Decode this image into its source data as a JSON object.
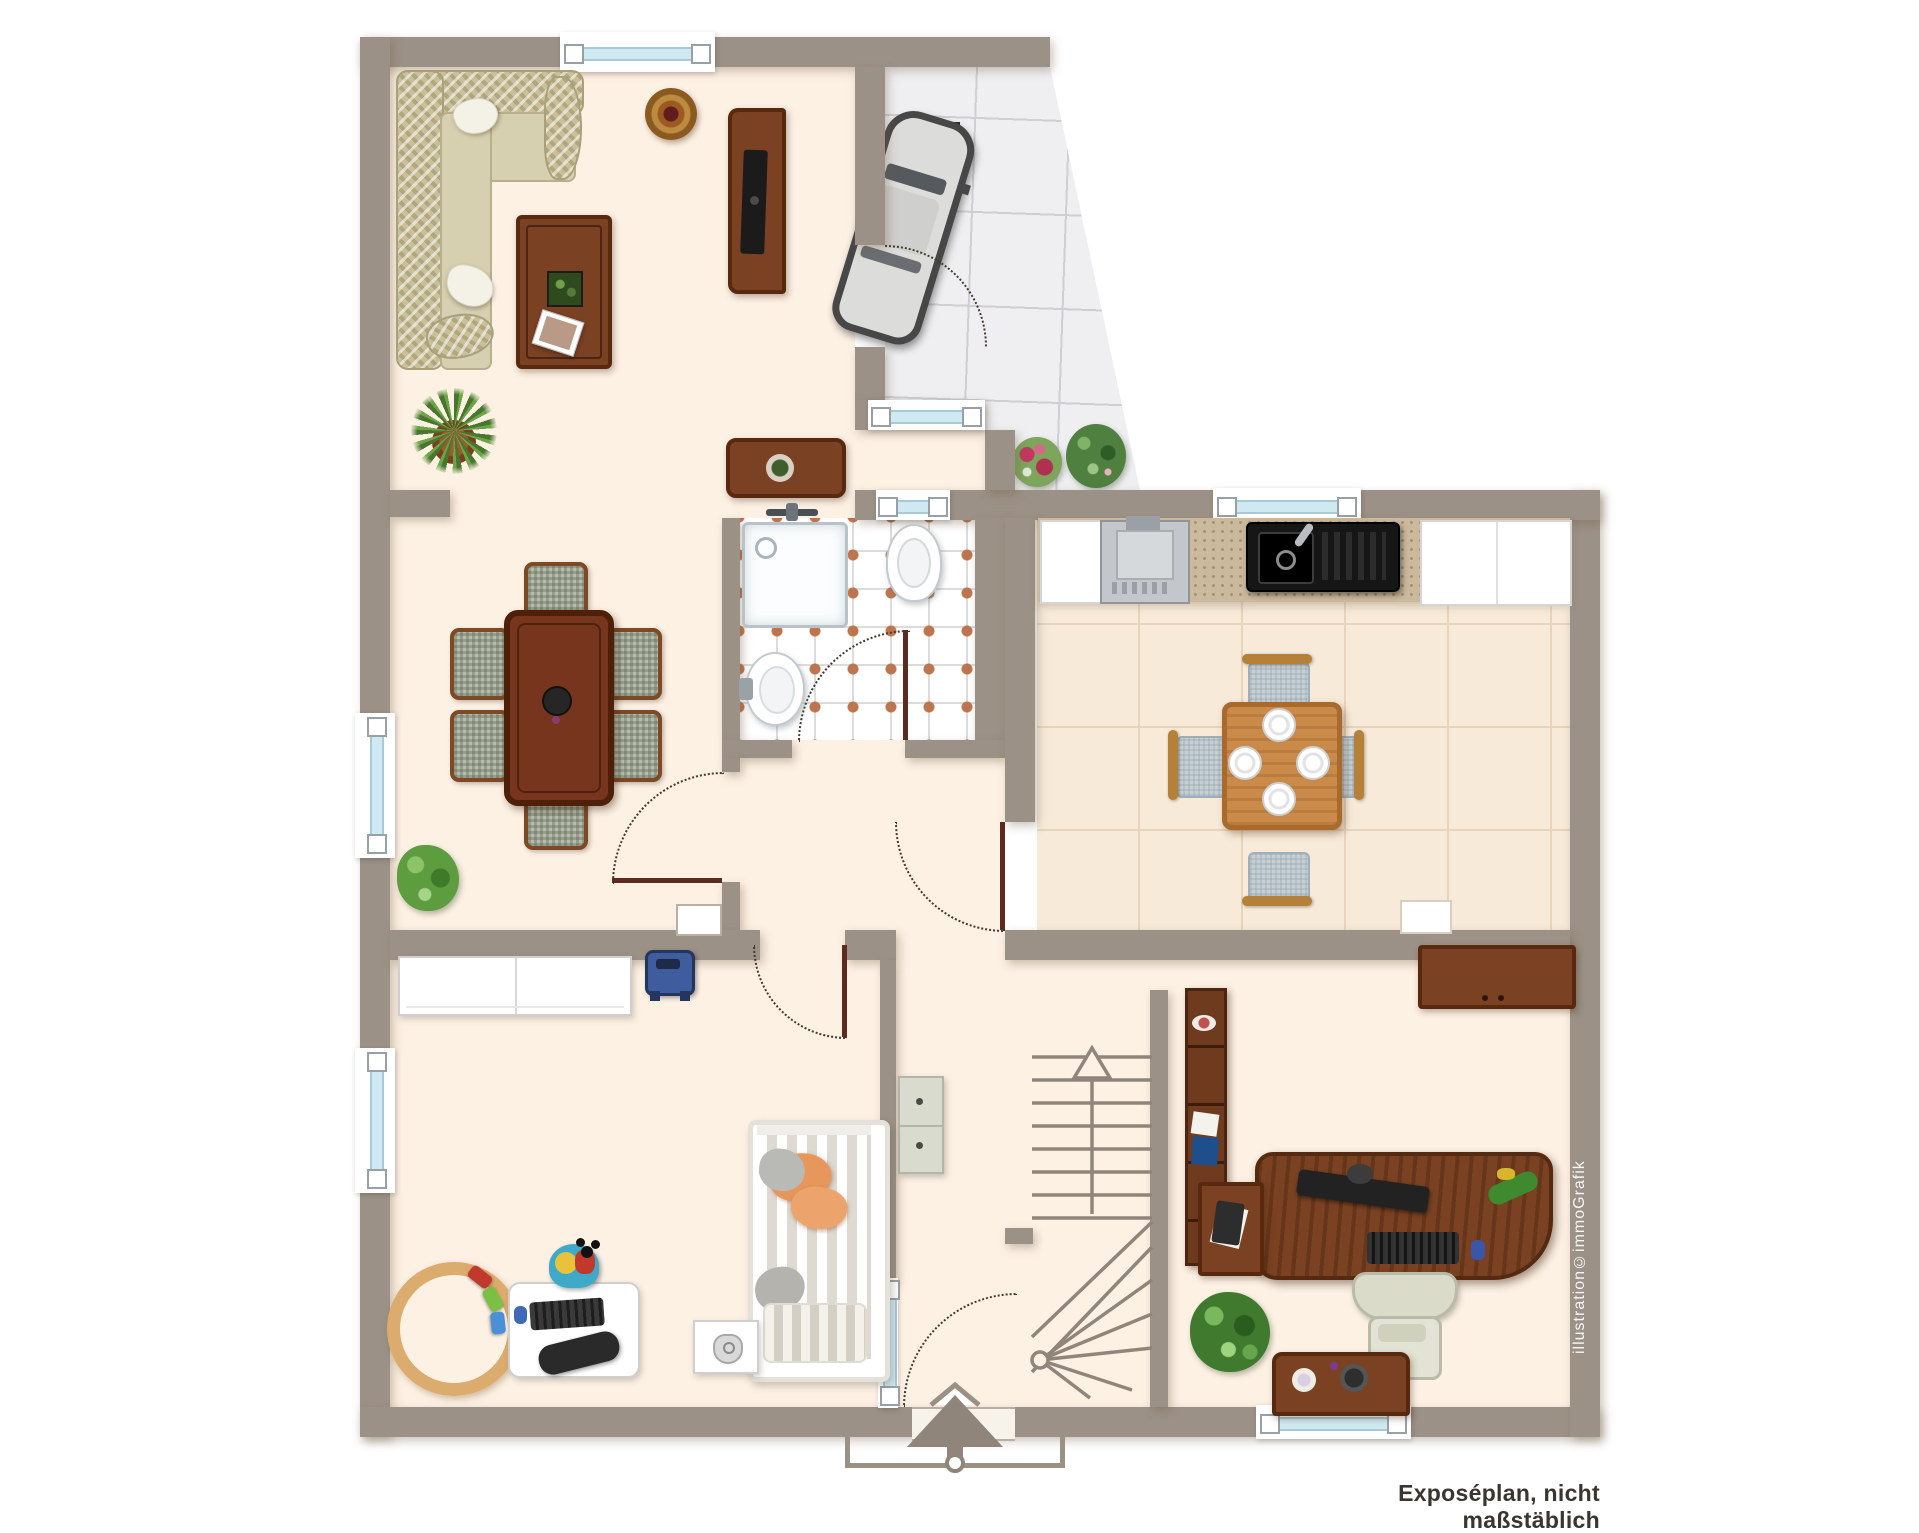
{
  "meta": {
    "type": "floor-plan",
    "plan_kind": "Exposéplan (real-estate exposé drawing)",
    "scale_note_shown": true
  },
  "labels": {
    "caption": "Exposéplan, nicht maßstäblich",
    "watermark": "illustration©immoGrafik"
  },
  "palette": {
    "wall": "#9c9186",
    "floor_cream": "#fdf1e4",
    "kitchen_floor": "#f7ead9",
    "bathroom_tile_accent": "#bd7550",
    "carport_tile": "#efeff1",
    "window_glass": "#cfe9f2",
    "door_leaf": "#5d2a1f",
    "wood_dark": "#7a4122",
    "wood_light": "#c98a4a",
    "sofa_beige": "#c9bf98",
    "symbol_gray": "#8f857a"
  },
  "rooms": [
    {
      "name": "living-room",
      "position": "top-left",
      "furniture": [
        "corner-sofa-with-pillows",
        "round-rug",
        "coffee-table-with-planter-and-photo",
        "tv-sideboard",
        "yucca-plant",
        "sideboard-with-plant-dish"
      ]
    },
    {
      "name": "carport-terrace",
      "position": "top-right",
      "floor": "marble-tiles-slanted-edge",
      "furniture": [
        "car-top-view",
        "floor-drain-grate",
        "red-flower-bush",
        "green-flower-bush"
      ]
    },
    {
      "name": "dining-room",
      "position": "middle-left",
      "furniture": [
        "rectangular-dining-table",
        "six-upholstered-chairs",
        "table-centerpiece-bowl",
        "potted-plant"
      ]
    },
    {
      "name": "bathroom",
      "position": "center",
      "floor": "white-tiles-terracotta-diamonds",
      "furniture": [
        "shower-with-fixture",
        "toilet",
        "washbasin-with-faucet"
      ]
    },
    {
      "name": "kitchen",
      "position": "middle-right",
      "furniture": [
        "stove",
        "granite-counter",
        "black-sink-with-drainboard",
        "white-cabinets",
        "tall-white-cabinet",
        "square-wood-table",
        "four-chairs",
        "four-place-settings",
        "radiator"
      ]
    },
    {
      "name": "hallway",
      "position": "center-bottom",
      "furniture": [
        "shoe-cabinet",
        "blue-toy-car",
        "wall-niche"
      ]
    },
    {
      "name": "staircase",
      "position": "bottom-center",
      "direction_arrow": "up",
      "elements": [
        "straight-treads",
        "winder-treads",
        "newel-post-circle",
        "diagonal-stringers"
      ]
    },
    {
      "name": "kids-room",
      "position": "bottom-left",
      "furniture": [
        "white-wardrobe",
        "bed-striped-duvet-orange-gray-pillows",
        "white-desk-with-keyboard-mouse",
        "game-steering-wheel",
        "mickey-play-chair",
        "wooden-train-track-circle",
        "white-mat-with-device"
      ]
    },
    {
      "name": "office",
      "position": "bottom-right",
      "furniture": [
        "tall-bookshelf-with-binders",
        "wall-sideboard",
        "curved-desk",
        "monitor",
        "keyboard",
        "mouse",
        "desk-accessories",
        "side-table-with-book",
        "office-chair",
        "green-plant",
        "low-sideboard-with-decor"
      ]
    }
  ],
  "symbols": {
    "entrance_arrow_direction": "up",
    "entrance_porch_outline": true,
    "door_swing_arcs": 6,
    "windows_count": 8,
    "stair_up_arrow": true
  }
}
